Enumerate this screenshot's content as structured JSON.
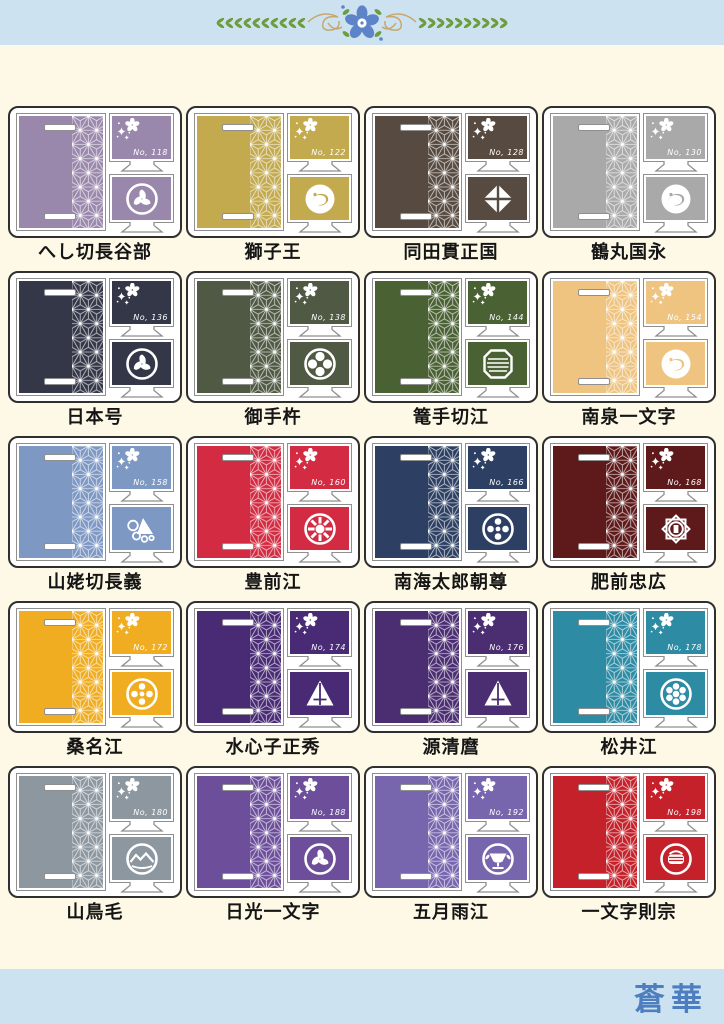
{
  "header": {
    "motif": "laurel-sakura-divider"
  },
  "footer": {
    "brand": "蒼華"
  },
  "colors": {
    "band_bg": "#cde2f0",
    "body_bg": "#fdf9e6",
    "brand_text": "#4d7fc0",
    "card_border": "#2f2f2f",
    "inner_border": "#8f8f8f"
  },
  "products": [
    {
      "name": "へし切長谷部",
      "number": "No, 118",
      "color": "#9a88ac",
      "crest": "tomoe-circle"
    },
    {
      "name": "獅子王",
      "number": "No, 122",
      "color": "#c3aa4f",
      "crest": "moon-swirl-disc"
    },
    {
      "name": "同田貫正国",
      "number": "No, 128",
      "color": "#574a40",
      "crest": "split-diamond"
    },
    {
      "name": "鶴丸国永",
      "number": "No, 130",
      "color": "#a9a9a9",
      "crest": "crane-disc"
    },
    {
      "name": "日本号",
      "number": "No, 136",
      "color": "#343748",
      "crest": "dragon-tomoe-circle"
    },
    {
      "name": "御手杵",
      "number": "No, 138",
      "color": "#505943",
      "crest": "cross-petal-circle"
    },
    {
      "name": "篭手切江",
      "number": "No, 144",
      "color": "#4a6134",
      "crest": "lined-octagon"
    },
    {
      "name": "南泉一文字",
      "number": "No, 154",
      "color": "#eec480",
      "crest": "cat-disc"
    },
    {
      "name": "山姥切長義",
      "number": "No, 158",
      "color": "#7e98c4",
      "crest": "grape-sail-cluster"
    },
    {
      "name": "豊前江",
      "number": "No, 160",
      "color": "#d32c42",
      "crest": "spoked-wheel-circle"
    },
    {
      "name": "南海太郎朝尊",
      "number": "No, 166",
      "color": "#2d4063",
      "crest": "four-dot-circle"
    },
    {
      "name": "肥前忠広",
      "number": "No, 168",
      "color": "#5e1a1b",
      "crest": "eight-point-star"
    },
    {
      "name": "桑名江",
      "number": "No, 172",
      "color": "#f0ad22",
      "crest": "kutsuwa-circle"
    },
    {
      "name": "水心子正秀",
      "number": "No, 174",
      "color": "#482a75",
      "crest": "sail-triangle"
    },
    {
      "name": "源清麿",
      "number": "No, 176",
      "color": "#4b2d72",
      "crest": "sail-triangle"
    },
    {
      "name": "松井江",
      "number": "No, 178",
      "color": "#2d8ba4",
      "crest": "seven-dot-circle"
    },
    {
      "name": "山鳥毛",
      "number": "No, 180",
      "color": "#8d97a0",
      "crest": "mountain-circle"
    },
    {
      "name": "日光一文字",
      "number": "No, 188",
      "color": "#6c4e9b",
      "crest": "tomoe-circle"
    },
    {
      "name": "五月雨江",
      "number": "No, 192",
      "color": "#7765ae",
      "crest": "cup-circle"
    },
    {
      "name": "一文字則宗",
      "number": "No, 198",
      "color": "#c4212a",
      "crest": "basket-circle"
    }
  ]
}
